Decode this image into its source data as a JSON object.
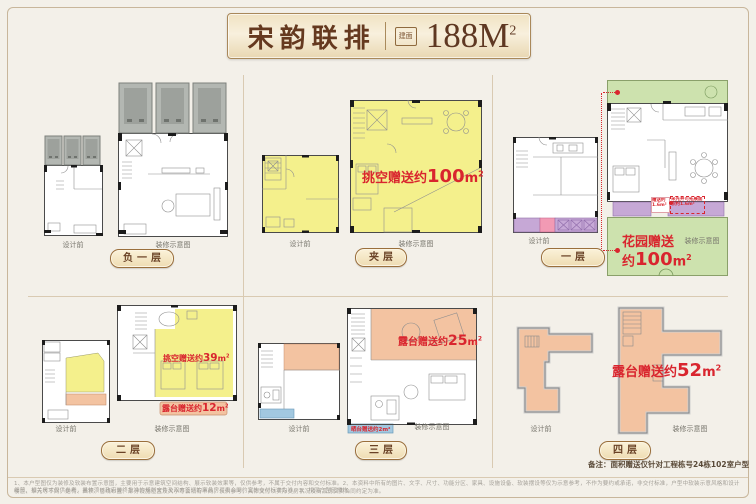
{
  "header": {
    "title": "宋韵联排",
    "seal": "建面",
    "area": "188M",
    "area_sup": "2"
  },
  "units": {
    "sqm": "m",
    "sup": "2"
  },
  "plan_labels": {
    "before": "设计前",
    "after": "装修示意图"
  },
  "floors": {
    "b1": "负一层",
    "mezz": "夹层",
    "f1": "一层",
    "f2": "二层",
    "f3": "三层",
    "f4": "四层"
  },
  "annotations": {
    "mezz_void_prefix": "挑空赠送约",
    "mezz_void_value": "100",
    "f1_garden_line1": "花园赠送",
    "f1_garden_prefix": "约",
    "f1_garden_value": "100",
    "f1_gift_small": "赠送约1.6m²",
    "f1_lightwell": "采光井可拓展面积约1.6m²",
    "f2_void_prefix": "挑空赠送约",
    "f2_void_value": "39",
    "f2_terrace_prefix": "露台赠送约",
    "f2_terrace_value": "12",
    "f3_terrace_prefix": "露台赠送约",
    "f3_terrace_value": "25",
    "f3_sundeck": "晒台赠送约2m²",
    "f4_terrace_prefix": "露台赠送约",
    "f4_terrace_value": "52"
  },
  "note": "备注：面积赠送仅针对工程栋号24栋102室户型",
  "disclaimer": {
    "line1": "1、本户型图仅为装修及软装布置示意图，主要用于示意建筑空间结构、展示软装效果等，仅供参考，不属于交付内容和交付标准。2、本资料中所有的图片、文字、尺寸、功能分区、家具、设施设备、软装摆设等仅为示意参考，不作为要约或承诺，非交付标准，户型中软装示意风格和设计细节、相关尺寸仅供参考，具体须以政府最终批准的规划文件及双方签订的商品房买卖合同约定的交付标准为准。3、相同户型因楼栋、",
    "line2": "楼层、单元等不同，结构、面积、管线布置、部分设施位置及大小等会稍有不同，仅供参考，具体交付以实际交房状况及商品房买卖合同约定为准。"
  }
}
